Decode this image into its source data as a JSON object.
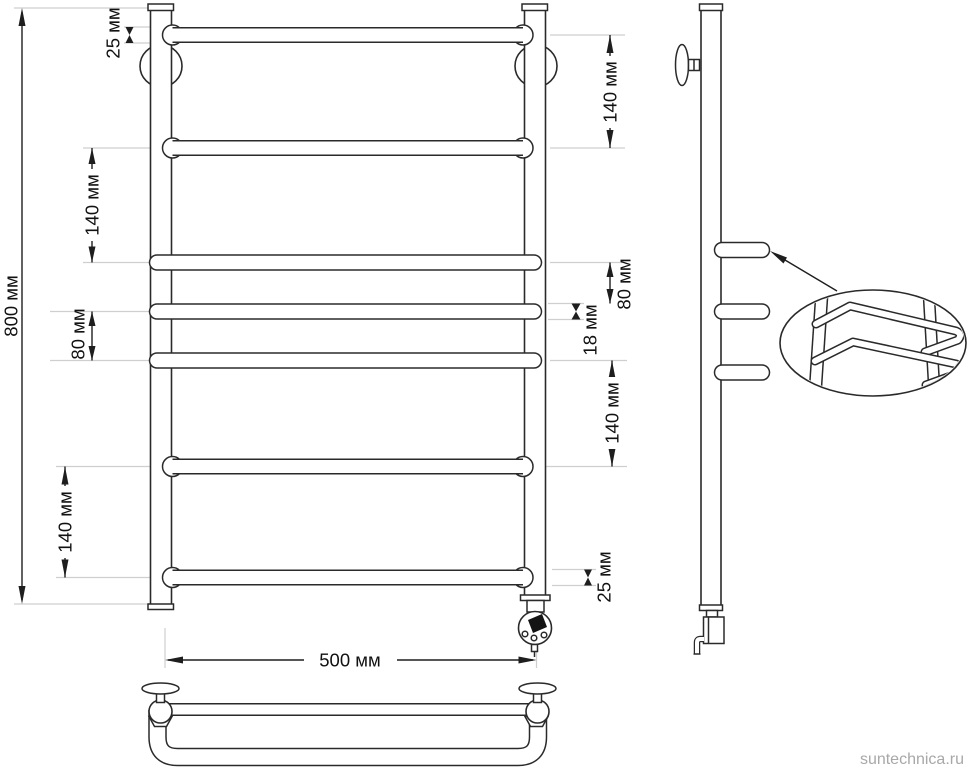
{
  "drawing": {
    "watermark": "suntechnica.ru",
    "dimensions": {
      "overall_height": "800 мм",
      "overall_width": "500 мм",
      "top_offset": "25 мм",
      "bottom_offset": "25 мм",
      "left_upper_gap": "140 мм",
      "left_middle_gap": "80 мм",
      "left_lower_gap": "140 мм",
      "right_upper_gap": "140 мм",
      "right_middle_gap": "80 мм",
      "tube_diameter": "18 мм",
      "right_lower_gap": "140 мм"
    },
    "colors": {
      "line": "#2a2a2a",
      "extension_line": "#cfcfcf",
      "watermark": "#a8a8a8",
      "background": "#ffffff"
    }
  }
}
